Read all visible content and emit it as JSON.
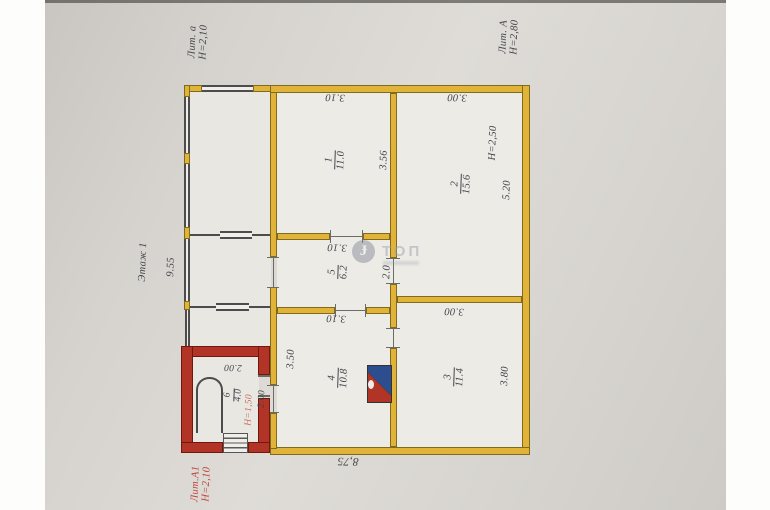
{
  "document": {
    "type_note": "floor plan photo",
    "floor_label": "Этаж 1",
    "watermark": {
      "text": "ТОП"
    },
    "annotations": {
      "veranda_top": {
        "lit": "Лит. а",
        "height": "Н=2,10"
      },
      "main_building": {
        "lit": "Лит. А",
        "height": "Н=2,80"
      },
      "veranda_bottom": {
        "lit": "Лит.А1",
        "height": "Н=2,10"
      }
    },
    "rooms": [
      {
        "number": "1",
        "area": "11.0"
      },
      {
        "number": "2",
        "area": "15.6",
        "height": "Н=2,50"
      },
      {
        "number": "3",
        "area": "11.4"
      },
      {
        "number": "4",
        "area": "10.8"
      },
      {
        "number": "5",
        "area": "6.2"
      },
      {
        "number": "6",
        "area": "4.0",
        "height": "Н=1,50"
      }
    ],
    "dimensions": {
      "room1_width": "3.10",
      "room1_depth": "3.56",
      "room2_width": "3.00",
      "room2_depth": "5.20",
      "room3_width": "3.00",
      "room3_depth": "3.80",
      "room4_width": "3.10",
      "room4_depth": "3.50",
      "room5_width": "3.10",
      "room5_depth": "2.0",
      "room6_width": "2.00",
      "room6_door": "2.00",
      "building_width": "8,75",
      "building_depth": "9.55"
    },
    "colors": {
      "wall_main": "#e2b339",
      "wall_veranda_red": "#b23427",
      "stove_blue": "#2d4e8e",
      "paper": "#d8d5d0",
      "ink": "#43454c",
      "red_ink": "#bd4437"
    }
  }
}
